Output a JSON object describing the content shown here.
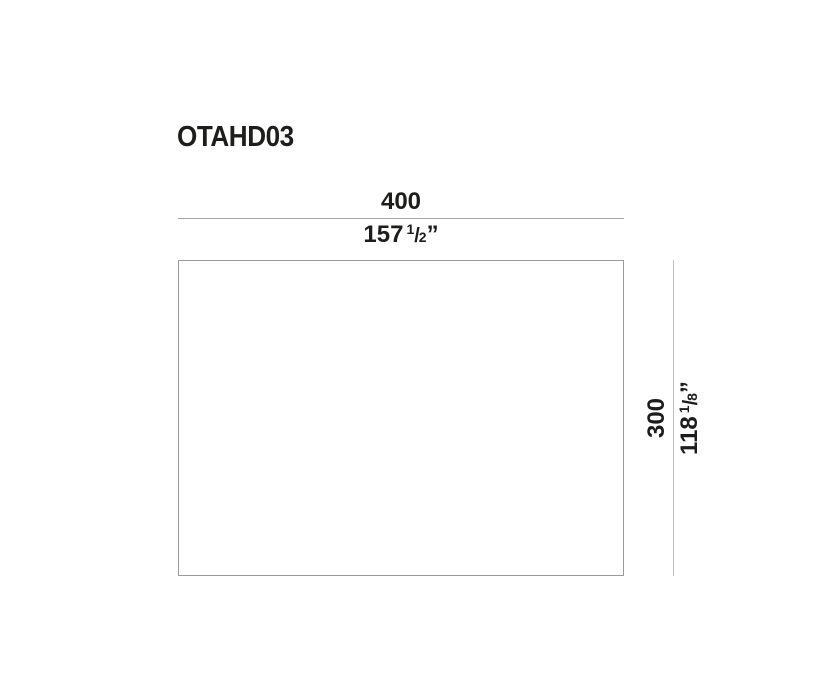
{
  "title": "OTAHD03",
  "colors": {
    "text": "#1d1d1b",
    "dimension_line": "#a6a6a6",
    "rect_border": "#9b9b9b",
    "background": "#ffffff"
  },
  "width_dimension": {
    "metric_value": "400",
    "imperial_whole": "157",
    "fraction_numerator": "1",
    "fraction_slash": "/",
    "fraction_denominator": "2",
    "unit_mark": "”"
  },
  "height_dimension": {
    "metric_value": "300",
    "imperial_whole": "118",
    "fraction_numerator": "1",
    "fraction_slash": "/",
    "fraction_denominator": "8",
    "unit_mark": "”"
  }
}
